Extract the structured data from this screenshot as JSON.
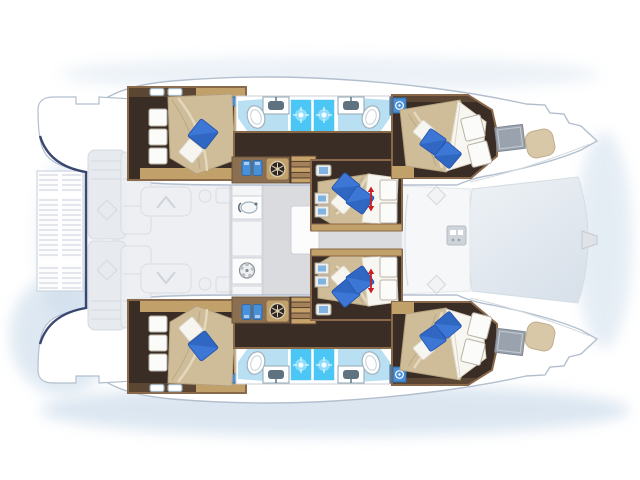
{
  "meta": {
    "title": "Catamaran yacht interior layout plan, top view, bow to the right",
    "description": "Six double cabins with blue accent pillows, two twin shower/bathroom blocks, central saloon with galley, aft grating platform, forward trampoline",
    "orientation": "bow-right"
  },
  "legend": {
    "double_cabins": 6,
    "blue_pillows": 10,
    "white_pillows": 6,
    "shower_stalls": 4,
    "toilets": 4,
    "washbasins": 4,
    "bed_length_arrows": 2,
    "washer_units": 2,
    "galley_sink": 1,
    "galley_hob": 1
  },
  "rooms": [
    {
      "id": "aft-cabin-port",
      "label": "Aft double cabin, port hull"
    },
    {
      "id": "forward-cabin-port",
      "label": "Forward double cabin, port hull"
    },
    {
      "id": "bathroom-port",
      "label": "Twin bathroom with showers, port hull"
    },
    {
      "id": "center-cabin-port",
      "label": "Forward nacelle cabin, port side"
    },
    {
      "id": "aft-cabin-starboard",
      "label": "Aft double cabin, starboard hull"
    },
    {
      "id": "forward-cabin-starboard",
      "label": "Forward double cabin, starboard hull"
    },
    {
      "id": "bathroom-starboard",
      "label": "Twin bathroom with showers, starboard hull"
    },
    {
      "id": "center-cabin-starboard",
      "label": "Forward nacelle cabin, starboard side"
    },
    {
      "id": "saloon-galley",
      "label": "Central saloon and galley"
    },
    {
      "id": "aft-platform",
      "label": "Aft teak grating platform"
    },
    {
      "id": "forward-cockpit",
      "label": "Forward cockpit"
    },
    {
      "id": "trampoline",
      "label": "Bow trampoline"
    }
  ],
  "icons": [
    "toilet-icon",
    "washbasin-icon",
    "shower-jet-icon",
    "washer-drum-icon",
    "jerry-can-icon",
    "galley-sink-icon",
    "hob-burner-icon",
    "bed-length-arrow-icon",
    "deck-hatch-icon",
    "diamond-hatch-icon"
  ],
  "colors": {
    "page_bg": "#ffffff",
    "water_shadow": "#bfd3e6",
    "hull_fill": "#ffffff",
    "hull_stroke": "#b3bfce",
    "deck_soft": "#e7eaee",
    "deck_stroke": "#d5dae1",
    "navy_outline": "#2a3a66",
    "wood_frame": "#8a684a",
    "wood_cabinet": "#c2a06a",
    "wood_dark_floor": "#3a2d25",
    "bed_quilt": "#cfbd99",
    "bed_quilt_shadow": "#b5a17d",
    "linen_white": "#f7f5ef",
    "pillow_blue": "#3d77d6",
    "pillow_blue_dark": "#2a57b0",
    "bath_floor": "#b9e0f2",
    "shower_blue": "#4cc6f4",
    "fixture_stroke": "#9fb2bd",
    "appliance_blue": "#4a90d9",
    "salon_floor": "#d9dbde",
    "galley_counter": "#e9eaed",
    "island_white": "#fcfcfd",
    "window_gray": "#9aa3ad",
    "pad_tan": "#d8c8a8",
    "grid_line": "#c7cfd9",
    "red_arrow": "#cc2020",
    "trampoline_light": "#eef2f6",
    "trampoline_dark": "#d9e1ea"
  }
}
